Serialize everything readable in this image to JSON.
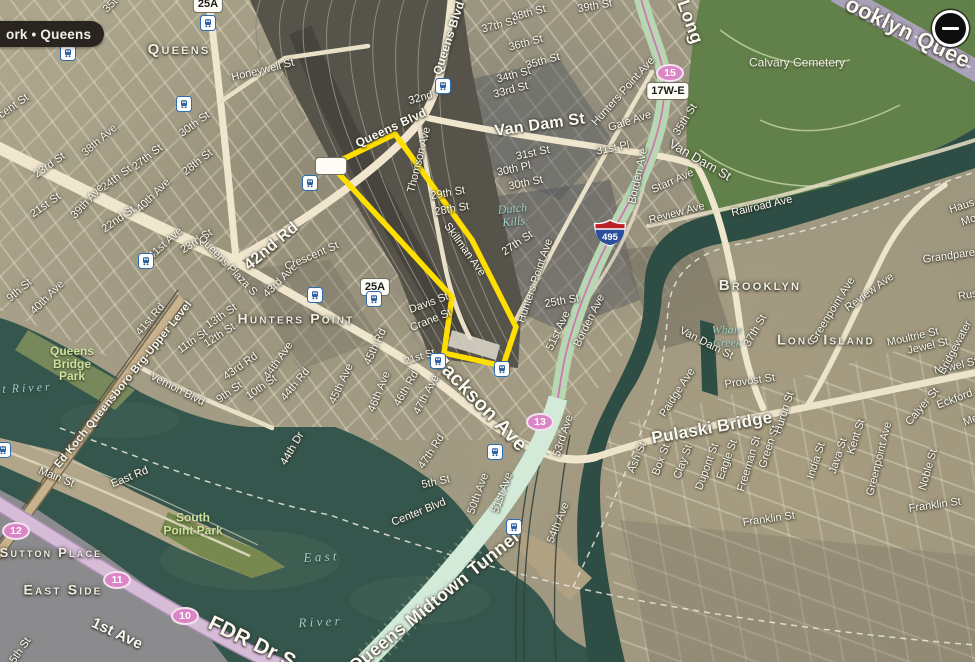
{
  "chrome": {
    "location_badge": "ork • Queens",
    "zoom_out_label": "−"
  },
  "colors": {
    "highlight_yellow": "#ffdf00",
    "water": "#35564c",
    "cemetery_green": "#628049",
    "route_shield_pink": "#dc85c6",
    "tunnel_mint": "#d3ead8",
    "fdr_pink": "#d7bcd8",
    "land_tan": "#a29b83"
  },
  "map": {
    "highlight": {
      "color": "#ffdf00",
      "points": [
        [
          395,
          134
        ],
        [
          331,
          165
        ],
        [
          452,
          297
        ],
        [
          444,
          353
        ],
        [
          503,
          366
        ],
        [
          516,
          327
        ],
        [
          472,
          240
        ]
      ]
    },
    "stations": [
      [
        208,
        23
      ],
      [
        68,
        53
      ],
      [
        443,
        86
      ],
      [
        184,
        104
      ],
      [
        310,
        183
      ],
      [
        146,
        261
      ],
      [
        315,
        295
      ],
      [
        374,
        299
      ],
      [
        438,
        361
      ],
      [
        502,
        369
      ],
      [
        3,
        450
      ],
      [
        495,
        452
      ],
      [
        514,
        527
      ]
    ],
    "shields": [
      {
        "kind": "squircle",
        "label": "25A",
        "x": 208,
        "y": 4
      },
      {
        "kind": "squircle",
        "label": "25A",
        "x": 375,
        "y": 287
      },
      {
        "kind": "squircle",
        "label": "17W-E",
        "x": 668,
        "y": 91
      },
      {
        "kind": "squircle",
        "label": "",
        "x": 331,
        "y": 166
      },
      {
        "kind": "ellipse",
        "label": "15",
        "x": 670,
        "y": 73
      },
      {
        "kind": "ellipse",
        "label": "13",
        "x": 540,
        "y": 422
      },
      {
        "kind": "ellipse",
        "label": "12",
        "x": 16,
        "y": 531
      },
      {
        "kind": "ellipse",
        "label": "11",
        "x": 117,
        "y": 580
      },
      {
        "kind": "ellipse",
        "label": "10",
        "x": 185,
        "y": 616
      },
      {
        "kind": "interstate",
        "label": "495",
        "x": 610,
        "y": 233
      }
    ],
    "labels": [
      {
        "t": "35t",
        "x": 111,
        "y": 6,
        "r": -45
      },
      {
        "t": "Queens",
        "x": 179,
        "y": 50,
        "r": 0,
        "s": 15,
        "k": "place"
      },
      {
        "t": "Honeywell St",
        "x": 263,
        "y": 71,
        "r": -14
      },
      {
        "t": "30th St",
        "x": 195,
        "y": 125,
        "r": -36
      },
      {
        "t": "38th Ave",
        "x": 100,
        "y": 141,
        "r": -41
      },
      {
        "t": "27th St",
        "x": 148,
        "y": 158,
        "r": -38
      },
      {
        "t": "28th St",
        "x": 198,
        "y": 163,
        "r": -38
      },
      {
        "t": "23rd St",
        "x": 50,
        "y": 166,
        "r": -35
      },
      {
        "t": "24th St",
        "x": 117,
        "y": 179,
        "r": -36
      },
      {
        "t": "39th Ave",
        "x": 88,
        "y": 202,
        "r": -47
      },
      {
        "t": "40th Ave",
        "x": 154,
        "y": 196,
        "r": -45
      },
      {
        "t": "21st St",
        "x": 46,
        "y": 206,
        "r": -35
      },
      {
        "t": "22nd St",
        "x": 119,
        "y": 220,
        "r": -35
      },
      {
        "t": "cent St",
        "x": 14,
        "y": 107,
        "r": -35
      },
      {
        "t": "23rd St",
        "x": 197,
        "y": 242,
        "r": -33
      },
      {
        "t": "41st Ave",
        "x": 166,
        "y": 244,
        "r": -42
      },
      {
        "t": "40th Ave",
        "x": 48,
        "y": 298,
        "r": -45
      },
      {
        "t": "9th St",
        "x": 20,
        "y": 291,
        "r": -40
      },
      {
        "t": "41st Rd",
        "x": 151,
        "y": 320,
        "r": -50
      },
      {
        "t": "Queens Plaza S",
        "x": 227,
        "y": 266,
        "r": 46
      },
      {
        "t": "42nd Rd",
        "x": 272,
        "y": 247,
        "r": -40,
        "s": 16,
        "k": "road-major"
      },
      {
        "t": "Crescent St",
        "x": 312,
        "y": 257,
        "r": -23
      },
      {
        "t": "43rd Ave",
        "x": 281,
        "y": 281,
        "r": -45
      },
      {
        "t": "13th St",
        "x": 222,
        "y": 317,
        "r": -34
      },
      {
        "t": "12th St",
        "x": 220,
        "y": 336,
        "r": -33
      },
      {
        "t": "11th St",
        "x": 193,
        "y": 342,
        "r": -35
      },
      {
        "t": "Hunters Point",
        "x": 296,
        "y": 319,
        "r": 0,
        "s": 14,
        "k": "place"
      },
      {
        "t": "43rd Rd",
        "x": 241,
        "y": 367,
        "r": -35
      },
      {
        "t": "44th Ave",
        "x": 279,
        "y": 361,
        "r": -55
      },
      {
        "t": "44th Rd",
        "x": 296,
        "y": 385,
        "r": -50
      },
      {
        "t": "10th St",
        "x": 262,
        "y": 388,
        "r": -35
      },
      {
        "t": "9th St",
        "x": 230,
        "y": 393,
        "r": -35
      },
      {
        "t": "45th Ave",
        "x": 342,
        "y": 384,
        "r": -65
      },
      {
        "t": "45th Rd",
        "x": 376,
        "y": 347,
        "r": -65
      },
      {
        "t": "46th Ave",
        "x": 380,
        "y": 392,
        "r": -68
      },
      {
        "t": "46th Rd",
        "x": 407,
        "y": 389,
        "r": -60
      },
      {
        "t": "47th Ave",
        "x": 427,
        "y": 395,
        "r": -62
      },
      {
        "t": "47th Rd",
        "x": 432,
        "y": 452,
        "r": -57
      },
      {
        "t": "44th Dr",
        "x": 293,
        "y": 449,
        "r": -60
      },
      {
        "t": "Vernon Blvd",
        "x": 177,
        "y": 390,
        "r": 27
      },
      {
        "t": "Ed Koch Queensboro Brg-Upper Level",
        "x": 124,
        "y": 385,
        "r": -51,
        "k": "road-major"
      },
      {
        "t": "Queens\nBridge\nPark",
        "x": 72,
        "y": 364,
        "r": 0,
        "s": 12,
        "k": "park"
      },
      {
        "t": "Main St",
        "x": 56,
        "y": 478,
        "r": 22
      },
      {
        "t": "East Rd",
        "x": 130,
        "y": 478,
        "r": -22
      },
      {
        "t": "South\nPoint Park",
        "x": 193,
        "y": 524,
        "r": 0,
        "s": 12,
        "k": "park"
      },
      {
        "t": "t  R i v e r",
        "x": 26,
        "y": 388,
        "r": -3,
        "s": 12,
        "k": "water"
      },
      {
        "t": "Sutton Place",
        "x": 51,
        "y": 553,
        "r": 0,
        "s": 13,
        "k": "place"
      },
      {
        "t": "East Side",
        "x": 63,
        "y": 590,
        "r": 0,
        "s": 14,
        "k": "place"
      },
      {
        "t": "1st Ave",
        "x": 117,
        "y": 634,
        "r": 25,
        "s": 15,
        "k": "road-major"
      },
      {
        "t": "FDR Dr S",
        "x": 252,
        "y": 643,
        "r": 26,
        "s": 21,
        "k": "road-major"
      },
      {
        "t": "5th St",
        "x": 21,
        "y": 651,
        "r": -55
      },
      {
        "t": "E a s t",
        "x": 320,
        "y": 557,
        "r": -3,
        "s": 13,
        "k": "water"
      },
      {
        "t": "R i v e r",
        "x": 319,
        "y": 622,
        "r": -3,
        "s": 13,
        "k": "water"
      },
      {
        "t": "Queens Midtown Tunnel",
        "x": 434,
        "y": 602,
        "r": -39,
        "s": 18,
        "k": "road-major"
      },
      {
        "t": "Center Blvd",
        "x": 419,
        "y": 513,
        "r": -22
      },
      {
        "t": "5th St",
        "x": 436,
        "y": 483,
        "r": -12
      },
      {
        "t": "50th Ave",
        "x": 479,
        "y": 494,
        "r": -70
      },
      {
        "t": "51st Ave",
        "x": 503,
        "y": 493,
        "r": -70
      },
      {
        "t": "54th Ave",
        "x": 559,
        "y": 523,
        "r": -68
      },
      {
        "t": "53rd Ave",
        "x": 564,
        "y": 436,
        "r": -72
      },
      {
        "t": "Jackson Ave",
        "x": 480,
        "y": 404,
        "r": 46,
        "s": 20,
        "k": "road-major"
      },
      {
        "t": "21st St",
        "x": 420,
        "y": 358,
        "r": -18,
        "s": 10
      },
      {
        "t": "Davis St",
        "x": 429,
        "y": 304,
        "r": -20
      },
      {
        "t": "Crane St",
        "x": 431,
        "y": 321,
        "r": -22
      },
      {
        "t": "Thomson Ave",
        "x": 420,
        "y": 160,
        "r": -76
      },
      {
        "t": "Queens Blvd",
        "x": 449,
        "y": 38,
        "r": -72,
        "s": 12,
        "k": "road-major"
      },
      {
        "t": "Queens Blvd",
        "x": 391,
        "y": 128,
        "r": -25,
        "s": 12,
        "k": "road-major"
      },
      {
        "t": "32nd Pl",
        "x": 427,
        "y": 97,
        "r": -16
      },
      {
        "t": "33rd St",
        "x": 511,
        "y": 91,
        "r": -15
      },
      {
        "t": "34th St",
        "x": 514,
        "y": 76,
        "r": -15
      },
      {
        "t": "35th St",
        "x": 543,
        "y": 62,
        "r": -15
      },
      {
        "t": "36th St",
        "x": 526,
        "y": 44,
        "r": -15
      },
      {
        "t": "37th St",
        "x": 499,
        "y": 26,
        "r": -15
      },
      {
        "t": "38th St",
        "x": 529,
        "y": 14,
        "r": -15
      },
      {
        "t": "39th St",
        "x": 595,
        "y": 7,
        "r": -10
      },
      {
        "t": "Van Dam St",
        "x": 540,
        "y": 126,
        "r": -8,
        "s": 16,
        "k": "road-major"
      },
      {
        "t": "Van Dam St",
        "x": 700,
        "y": 160,
        "r": 30,
        "s": 13
      },
      {
        "t": "Van Dam St",
        "x": 706,
        "y": 344,
        "r": 27
      },
      {
        "t": "29th St",
        "x": 448,
        "y": 194,
        "r": -10
      },
      {
        "t": "28th St",
        "x": 452,
        "y": 210,
        "r": -10
      },
      {
        "t": "Skillman Ave",
        "x": 464,
        "y": 250,
        "r": 54
      },
      {
        "t": "Dutch\nKills",
        "x": 513,
        "y": 215,
        "r": -5,
        "s": 12,
        "k": "water"
      },
      {
        "t": "31st St",
        "x": 533,
        "y": 154,
        "r": -12
      },
      {
        "t": "30th Pl",
        "x": 514,
        "y": 170,
        "r": -12
      },
      {
        "t": "30th St",
        "x": 526,
        "y": 184,
        "r": -12
      },
      {
        "t": "31st Pl",
        "x": 613,
        "y": 149,
        "r": -12
      },
      {
        "t": "Gale Ave",
        "x": 630,
        "y": 122,
        "r": -18
      },
      {
        "t": "Hunters Point Ave",
        "x": 624,
        "y": 92,
        "r": -48
      },
      {
        "t": "Hunters Point Ave",
        "x": 536,
        "y": 281,
        "r": -71
      },
      {
        "t": "27th St",
        "x": 518,
        "y": 244,
        "r": -34
      },
      {
        "t": "25th St",
        "x": 562,
        "y": 302,
        "r": -10
      },
      {
        "t": "Borden Ave",
        "x": 639,
        "y": 176,
        "r": -78
      },
      {
        "t": "Borden Ave",
        "x": 590,
        "y": 321,
        "r": -64
      },
      {
        "t": "51st Ave",
        "x": 559,
        "y": 331,
        "r": -65
      },
      {
        "t": "Starr Ave",
        "x": 673,
        "y": 182,
        "r": -24
      },
      {
        "t": "35th St",
        "x": 686,
        "y": 120,
        "r": -58
      },
      {
        "t": "Long",
        "x": 690,
        "y": 22,
        "r": 70,
        "s": 18,
        "k": "road-major"
      },
      {
        "t": "ooklyn Quee",
        "x": 908,
        "y": 32,
        "r": 26,
        "s": 22,
        "k": "road-major"
      },
      {
        "t": "Calvary Cemetery",
        "x": 797,
        "y": 63,
        "r": 0,
        "s": 12,
        "k": "place-sm"
      },
      {
        "t": "Long Island",
        "x": 826,
        "y": 340,
        "r": 0,
        "s": 14,
        "k": "place"
      },
      {
        "t": "Review Ave",
        "x": 677,
        "y": 214,
        "r": -15
      },
      {
        "t": "Review Ave",
        "x": 870,
        "y": 293,
        "r": -36
      },
      {
        "t": "Railroad Ave",
        "x": 762,
        "y": 207,
        "r": -13
      },
      {
        "t": "37th St",
        "x": 756,
        "y": 331,
        "r": -60
      },
      {
        "t": "Brooklyn",
        "x": 760,
        "y": 286,
        "r": 0,
        "s": 15,
        "k": "place"
      },
      {
        "t": "Greenpoint Ave",
        "x": 833,
        "y": 311,
        "r": -58
      },
      {
        "t": "Greenpoint Ave",
        "x": 880,
        "y": 459,
        "r": -76
      },
      {
        "t": "Whale\nCreek",
        "x": 727,
        "y": 336,
        "r": 0,
        "s": 12,
        "k": "water"
      },
      {
        "t": "Moultrie St",
        "x": 913,
        "y": 338,
        "r": -13
      },
      {
        "t": "Jewel St",
        "x": 928,
        "y": 347,
        "r": -13
      },
      {
        "t": "Newel St",
        "x": 956,
        "y": 367,
        "r": -13
      },
      {
        "t": "Grandpare",
        "x": 949,
        "y": 257,
        "r": -8
      },
      {
        "t": "Haus",
        "x": 962,
        "y": 207,
        "r": -18
      },
      {
        "t": "Mo",
        "x": 969,
        "y": 221,
        "r": -18
      },
      {
        "t": "Rus",
        "x": 968,
        "y": 296,
        "r": -10
      },
      {
        "t": "Bridgewater",
        "x": 956,
        "y": 348,
        "r": -62
      },
      {
        "t": "Provost St",
        "x": 750,
        "y": 382,
        "r": -8
      },
      {
        "t": "Paidge Ave",
        "x": 678,
        "y": 393,
        "r": -57
      },
      {
        "t": "Pulaski Bridge",
        "x": 712,
        "y": 428,
        "r": -10,
        "s": 17,
        "k": "road-major"
      },
      {
        "t": "Ash St",
        "x": 638,
        "y": 458,
        "r": -67
      },
      {
        "t": "Box St",
        "x": 662,
        "y": 460,
        "r": -70
      },
      {
        "t": "Clay St",
        "x": 684,
        "y": 462,
        "r": -70
      },
      {
        "t": "Dupont St",
        "x": 708,
        "y": 467,
        "r": -70
      },
      {
        "t": "Eagle St",
        "x": 728,
        "y": 460,
        "r": -70
      },
      {
        "t": "Freeman St",
        "x": 750,
        "y": 464,
        "r": -73
      },
      {
        "t": "Green St",
        "x": 770,
        "y": 447,
        "r": -72
      },
      {
        "t": "Huron St",
        "x": 785,
        "y": 413,
        "r": -72
      },
      {
        "t": "India St",
        "x": 817,
        "y": 461,
        "r": -72
      },
      {
        "t": "Java St",
        "x": 839,
        "y": 456,
        "r": -72
      },
      {
        "t": "Kent St",
        "x": 857,
        "y": 437,
        "r": -72
      },
      {
        "t": "Calyer St",
        "x": 923,
        "y": 407,
        "r": -50
      },
      {
        "t": "Eckford",
        "x": 955,
        "y": 400,
        "r": -20
      },
      {
        "t": "Noble St",
        "x": 929,
        "y": 470,
        "r": -74
      },
      {
        "t": "Franklin St",
        "x": 769,
        "y": 520,
        "r": -8
      },
      {
        "t": "Franklin St",
        "x": 935,
        "y": 506,
        "r": -8
      },
      {
        "t": "Me",
        "x": 971,
        "y": 421,
        "r": -20
      }
    ]
  }
}
